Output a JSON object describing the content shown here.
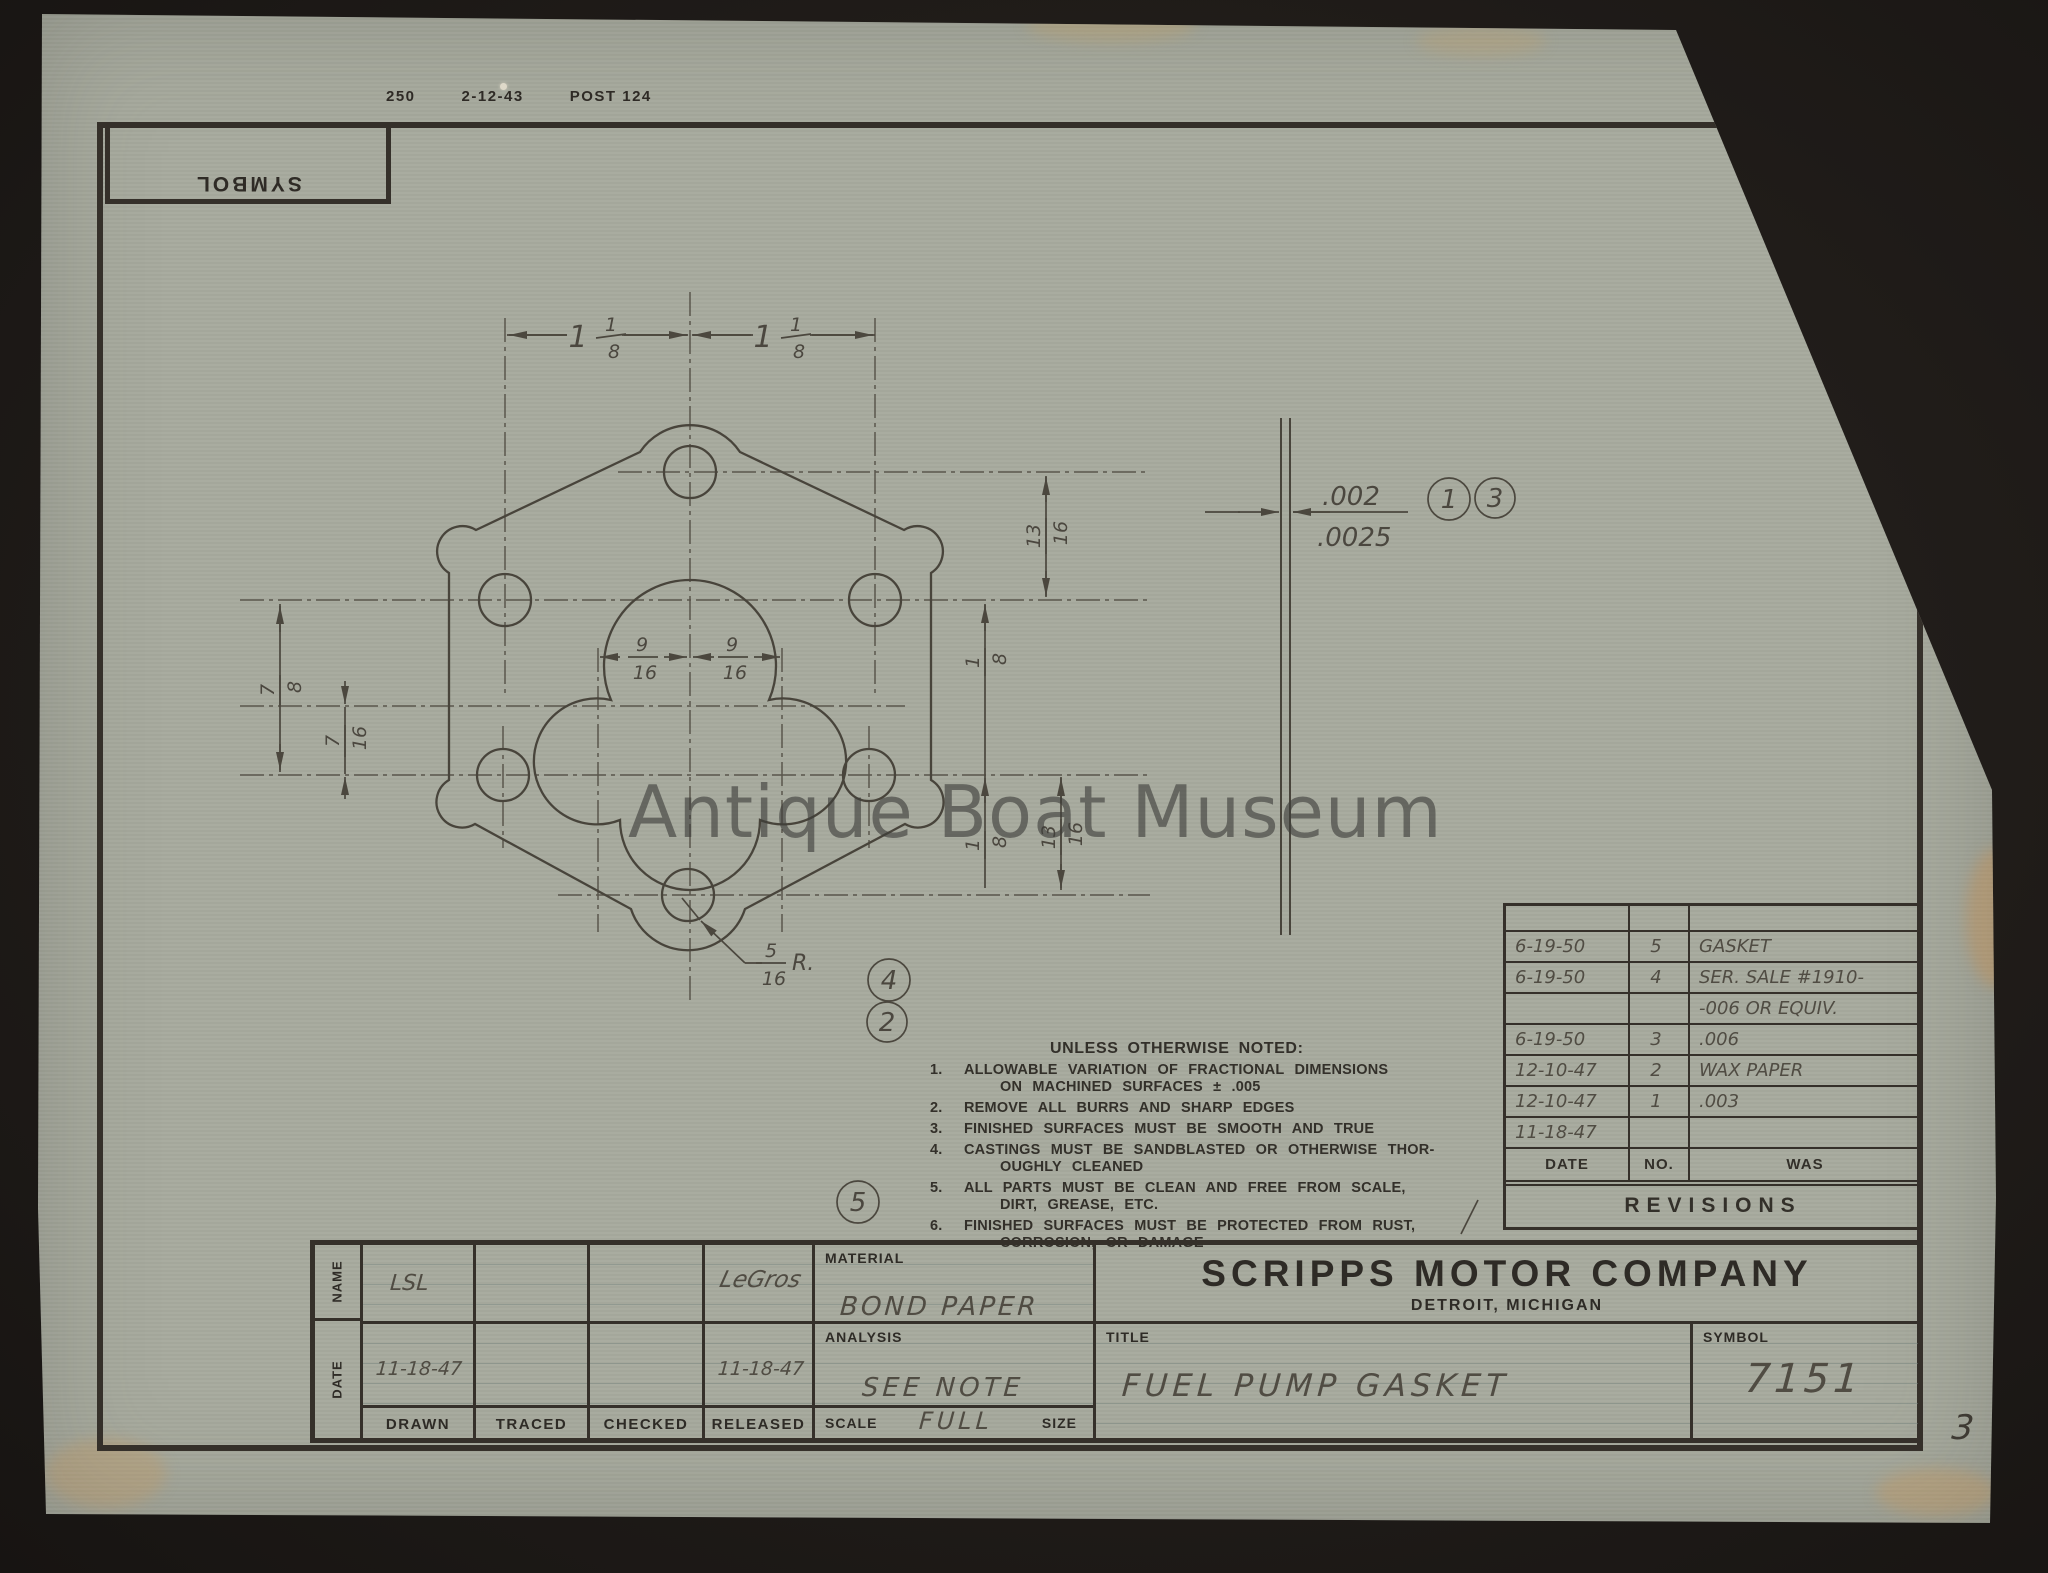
{
  "stamp": {
    "number": "250",
    "date": "2-12-43",
    "code": "POST 124"
  },
  "symbol_box": {
    "label": "SYMBOL"
  },
  "margin_number": "3",
  "watermark": {
    "text": "Antique Boat Museum"
  },
  "drawing": {
    "dims": {
      "top_left": {
        "whole": "1",
        "num": "1",
        "den": "8"
      },
      "top_right": {
        "whole": "1",
        "num": "1",
        "den": "8"
      },
      "left_outer": {
        "num": "7",
        "den": "8"
      },
      "left_inner": {
        "num": "7",
        "den": "16"
      },
      "bore_left": {
        "num": "9",
        "den": "16"
      },
      "bore_right": {
        "num": "9",
        "den": "16"
      },
      "right_upper": {
        "num": "13",
        "den": "16"
      },
      "right_mid": {
        "num": "1",
        "den": "8"
      },
      "right_lower_inner": {
        "num": "1",
        "den": "8"
      },
      "right_lower_outer": {
        "num": "13",
        "den": "16"
      },
      "corner_radius": {
        "num": "5",
        "den": "16",
        "suffix": "R."
      },
      "thickness": {
        "upper": ".002",
        "lower": ".0025"
      }
    },
    "balloons": {
      "one": "1",
      "two": "2",
      "three": "3",
      "four": "4",
      "five": "5"
    }
  },
  "notes": {
    "heading": "UNLESS OTHERWISE NOTED:",
    "items": [
      {
        "no": "1.",
        "l1": "ALLOWABLE VARIATION OF FRACTIONAL DIMENSIONS",
        "l2": "ON MACHINED SURFACES ± .005"
      },
      {
        "no": "2.",
        "l1": "REMOVE ALL BURRS AND SHARP EDGES",
        "l2": ""
      },
      {
        "no": "3.",
        "l1": "FINISHED SURFACES MUST BE SMOOTH AND TRUE",
        "l2": ""
      },
      {
        "no": "4.",
        "l1": "CASTINGS MUST BE SANDBLASTED OR OTHERWISE THOR-",
        "l2": "OUGHLY CLEANED"
      },
      {
        "no": "5.",
        "l1": "ALL PARTS MUST BE CLEAN AND FREE FROM SCALE,",
        "l2": "DIRT, GREASE, ETC."
      },
      {
        "no": "6.",
        "l1": "FINISHED SURFACES MUST BE PROTECTED FROM RUST,",
        "l2": "CORROSION, OR DAMAGE"
      }
    ]
  },
  "revisions": {
    "rows": [
      {
        "date": "",
        "no": "",
        "was": ""
      },
      {
        "date": "6-19-50",
        "no": "5",
        "was": "GASKET"
      },
      {
        "date": "6-19-50",
        "no": "4",
        "was": "SER. SALE #1910-"
      },
      {
        "date": "",
        "no": "",
        "was": "-006 OR EQUIV."
      },
      {
        "date": "6-19-50",
        "no": "3",
        "was": ".006"
      },
      {
        "date": "12-10-47",
        "no": "2",
        "was": "WAX PAPER"
      },
      {
        "date": "12-10-47",
        "no": "1",
        "was": ".003"
      },
      {
        "date": "11-18-47",
        "no": "",
        "was": ""
      }
    ],
    "header": {
      "date": "DATE",
      "no": "NO.",
      "was": "WAS"
    },
    "caption": "REVISIONS"
  },
  "title_block": {
    "name_label": "NAME",
    "date_label": "DATE",
    "col_labels": [
      "DRAWN",
      "TRACED",
      "CHECKED",
      "RELEASED"
    ],
    "name_row": {
      "drawn": "LSL",
      "traced": "",
      "checked": "",
      "released": "LeGros"
    },
    "date_row": {
      "drawn": "11-18-47",
      "traced": "",
      "checked": "",
      "released": "11-18-47"
    },
    "material_label": "MATERIAL",
    "material_value": "BOND PAPER",
    "analysis_label": "ANALYSIS",
    "analysis_value": "SEE NOTE",
    "scale_label": "SCALE",
    "scale_value": "FULL",
    "size_label": "SIZE",
    "company_name": "SCRIPPS MOTOR COMPANY",
    "company_location": "DETROIT, MICHIGAN",
    "title_label": "TITLE",
    "title_value": "FUEL PUMP GASKET",
    "symbol_label": "SYMBOL",
    "symbol_value": "7151"
  }
}
